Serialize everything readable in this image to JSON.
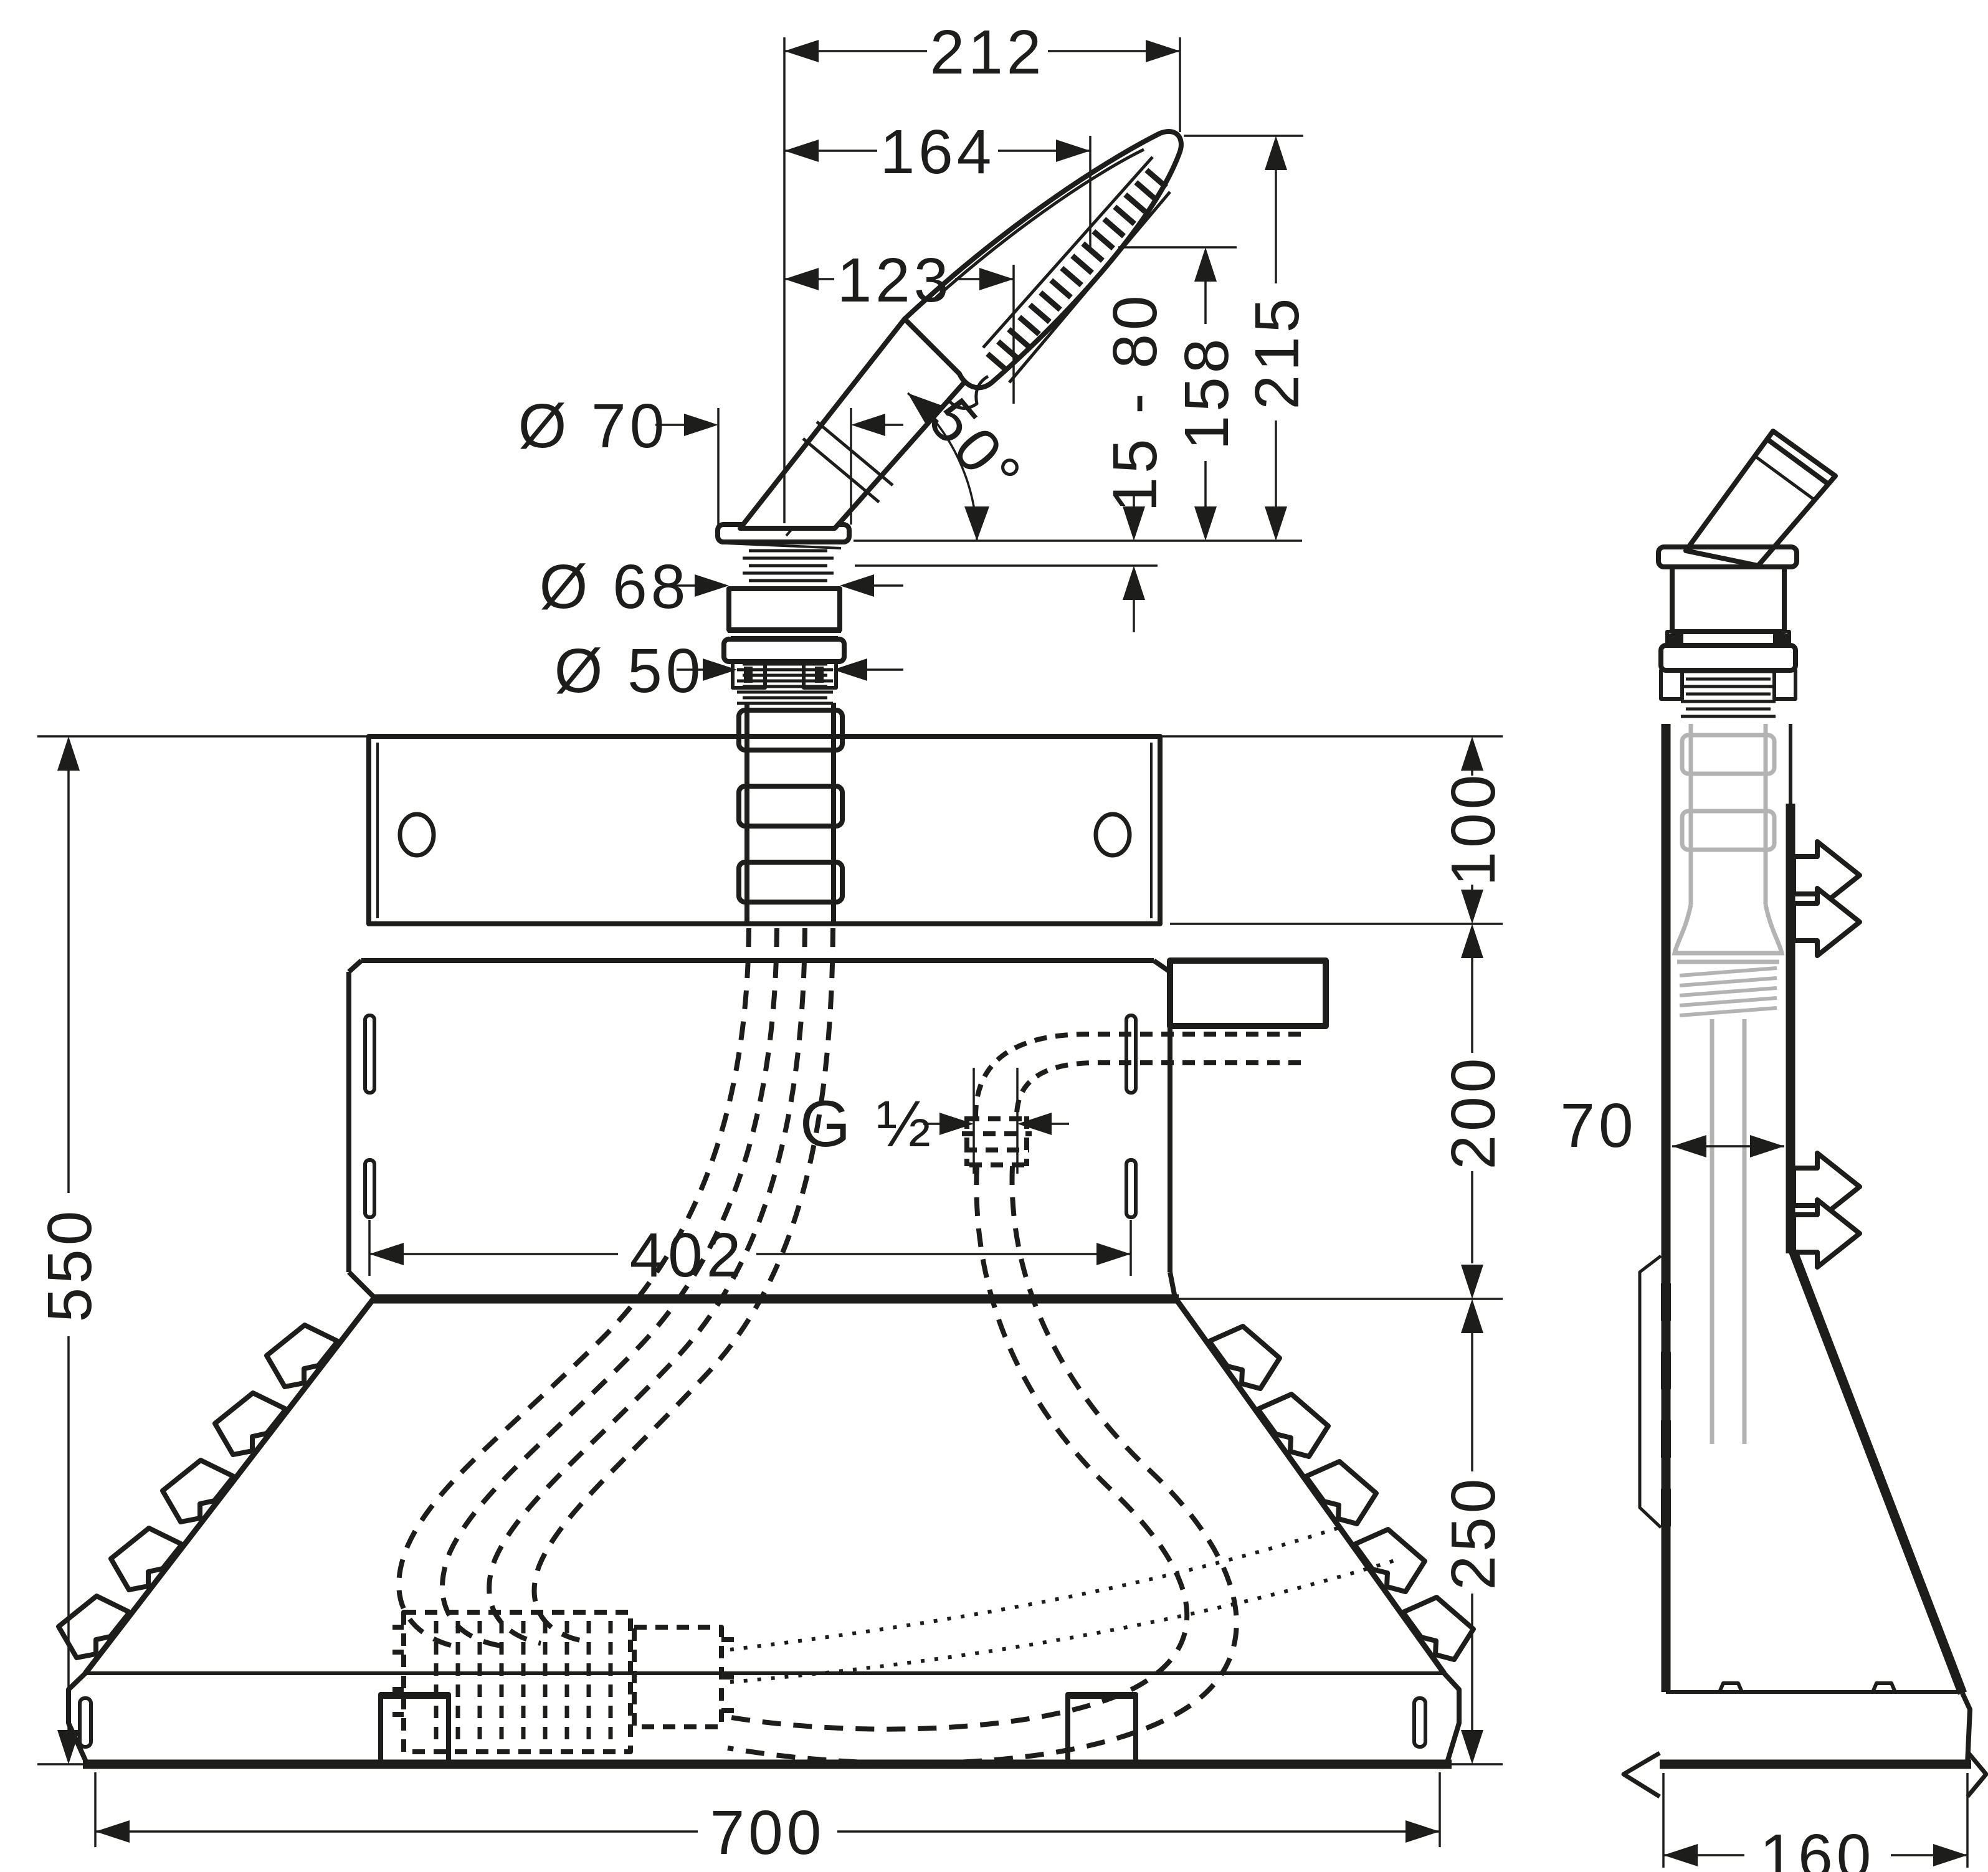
{
  "document": {
    "type": "installation technical drawing",
    "background": "#ffffff",
    "line_color": "#1d1d1b"
  },
  "dimensions": {
    "top_widths": {
      "d212": "212",
      "d164": "164",
      "d123": "123"
    },
    "heights_right": {
      "d215": "215",
      "d158": "158",
      "range": "15 - 80"
    },
    "angle": {
      "value": "50°"
    },
    "diameters": {
      "d70": "Ø 70",
      "d68": "Ø 68",
      "d50": "Ø 50"
    },
    "right_chain": {
      "d100": "100",
      "d200": "200",
      "d250": "250"
    },
    "overall_height": {
      "d550": "550"
    },
    "thread": {
      "g_half": "G ½"
    },
    "widths_bottom": {
      "d402": "402",
      "d700": "700"
    },
    "side_view": {
      "d70": "70",
      "d160": "160"
    }
  }
}
